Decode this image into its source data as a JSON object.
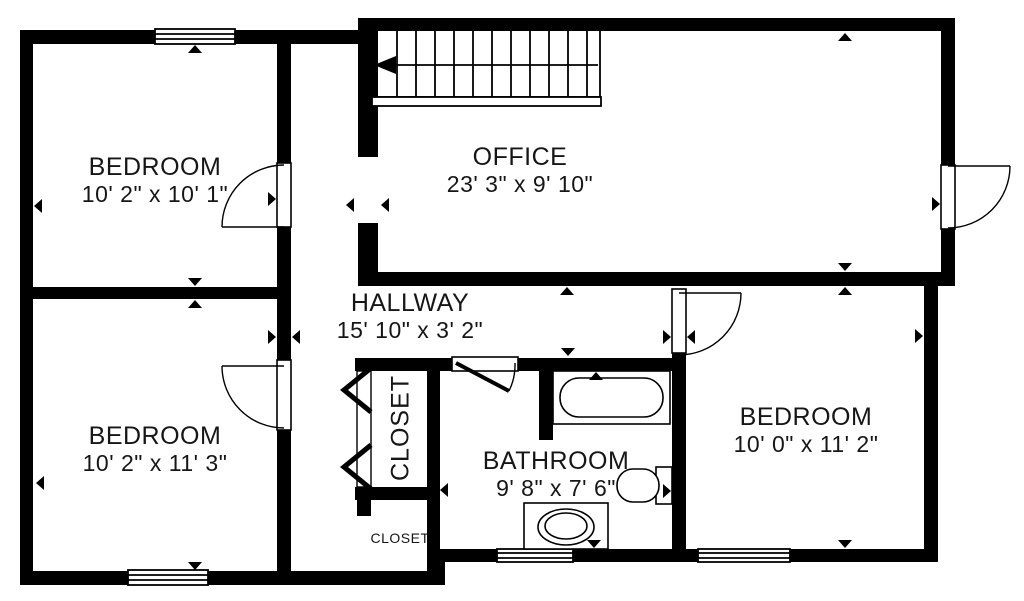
{
  "plan_title": "Floor plan",
  "rooms": {
    "bedroom1": {
      "name": "BEDROOM",
      "dims": "10' 2\" x 10' 1\""
    },
    "office": {
      "name": "OFFICE",
      "dims": "23' 3\" x 9' 10\""
    },
    "hallway": {
      "name": "HALLWAY",
      "dims": "15' 10\" x 3' 2\""
    },
    "bedroom2": {
      "name": "BEDROOM",
      "dims": "10' 2\" x 11' 3\""
    },
    "closet": {
      "name": "CLOSET"
    },
    "bathroom": {
      "name": "BATHROOM",
      "dims": "9' 8\" x 7' 6\""
    },
    "bedroom3": {
      "name": "BEDROOM",
      "dims": "10' 0\" x 11' 2\""
    },
    "closet_small": {
      "name": "CLOSET"
    }
  },
  "fixtures": [
    "staircase",
    "bathtub",
    "toilet",
    "sink-vanity"
  ],
  "colors": {
    "wall": "#000000",
    "floor": "#ffffff",
    "text": "#161616"
  }
}
